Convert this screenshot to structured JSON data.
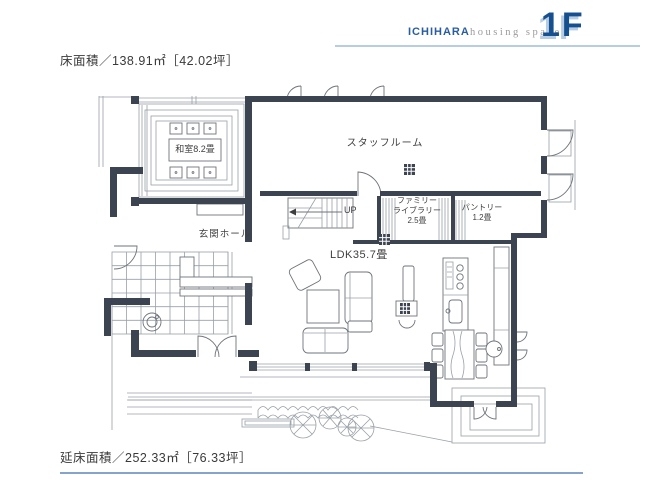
{
  "header": {
    "brand": "ICHIHARA",
    "brand_sub": "housing space",
    "floor": "1F"
  },
  "areas": {
    "floor_area": "床面積／138.91㎡［42.02坪］",
    "total_floor_area": "延床面積／252.33㎡［76.33坪］"
  },
  "rooms": {
    "washitsu": "和室8.2畳",
    "staff_room": "スタッフルーム",
    "entrance_hall": "玄関ホール",
    "stairs_up": "UP",
    "family_library_line1": "ファミリー",
    "family_library_line2": "ライブラリー",
    "family_library_size": "2.5畳",
    "pantry": "パントリー",
    "pantry_size": "1.2畳",
    "ldk": "LDK35.7畳"
  },
  "colors": {
    "accent_blue": "#17508f",
    "brand_blue": "#2a5d9f",
    "light_blue": "#b7cde3",
    "footer_line": "#86a3c9",
    "wall": "#3c4351"
  }
}
